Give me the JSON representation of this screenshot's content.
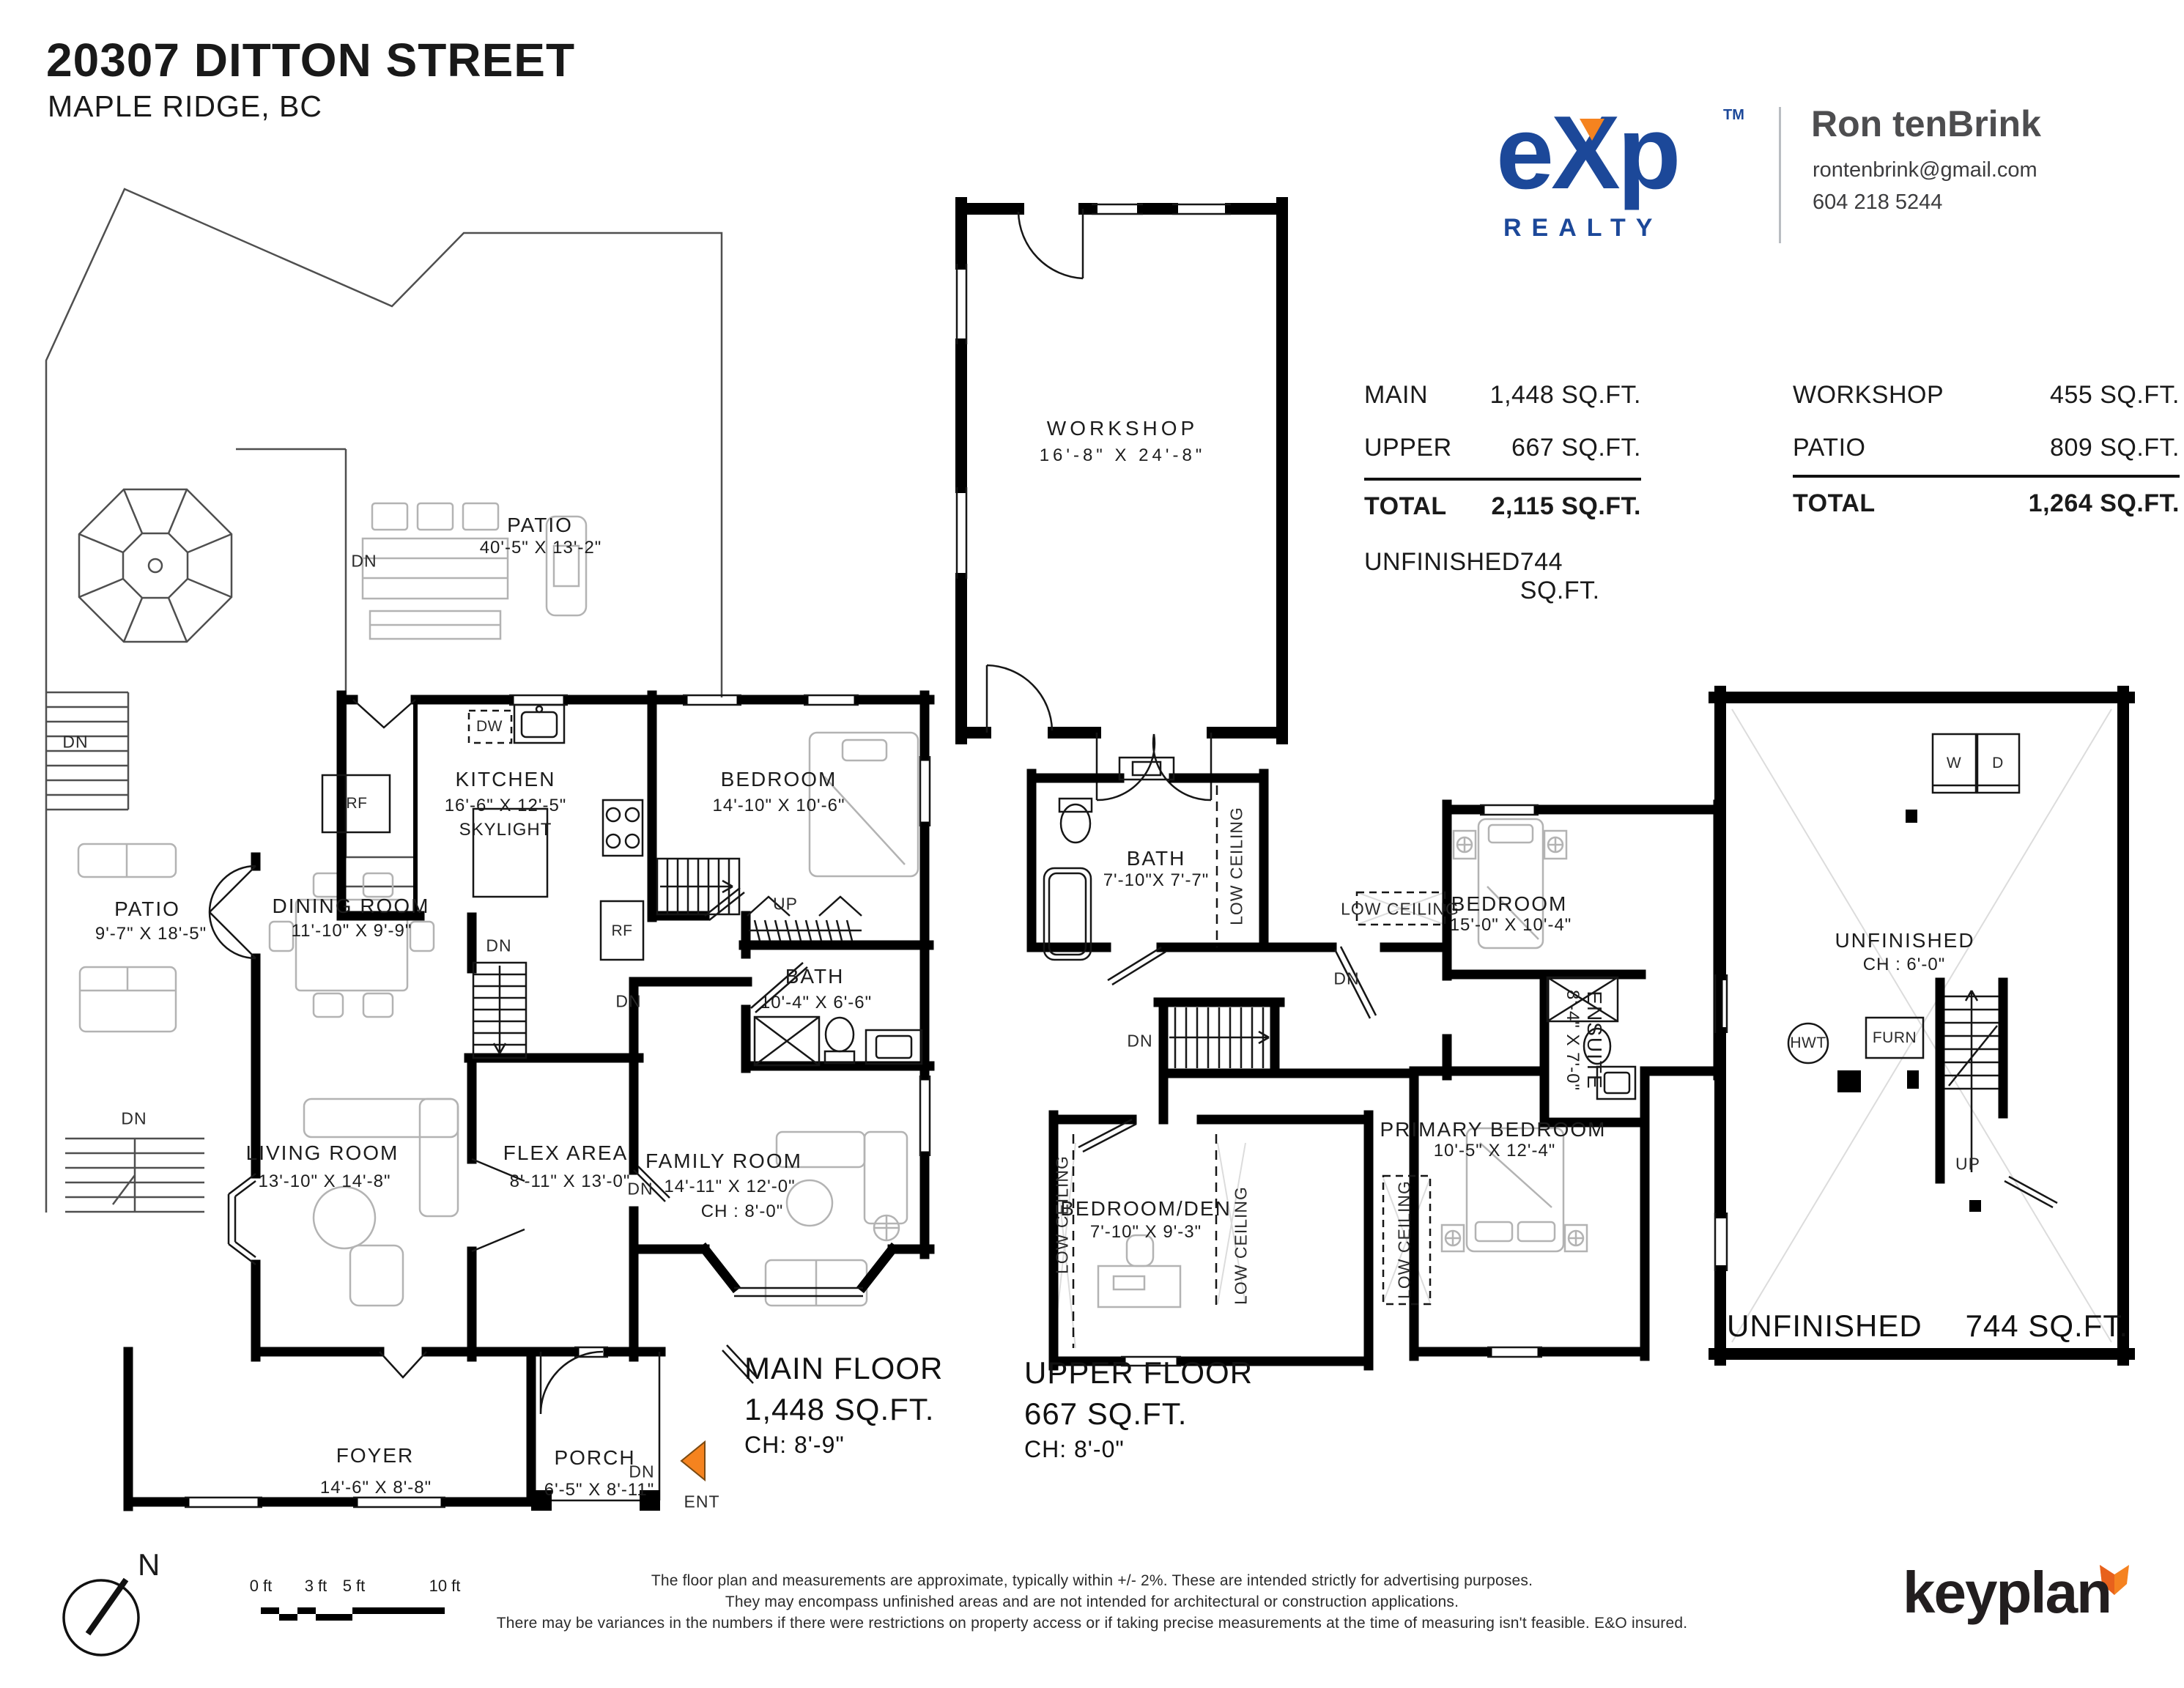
{
  "header": {
    "address": "20307 DITTON STREET",
    "city": "MAPLE RIDGE, BC"
  },
  "brand": {
    "exp": "eXp",
    "tm": "TM",
    "realty": "REALTY",
    "blue": "#1c4899",
    "orange": "#f5831f",
    "agent_name": "Ron tenBrink",
    "agent_email": "rontenbrink@gmail.com",
    "agent_phone": "604 218 5244"
  },
  "area_table": {
    "left": {
      "rows": [
        {
          "label": "MAIN",
          "value": "1,448 SQ.FT."
        },
        {
          "label": "UPPER",
          "value": "667 SQ.FT."
        }
      ],
      "total": {
        "label": "TOTAL",
        "value": "2,115 SQ.FT."
      },
      "unfinished": {
        "label": "UNFINISHED",
        "value": "744 SQ.FT."
      }
    },
    "right": {
      "rows": [
        {
          "label": "WORKSHOP",
          "value": "455 SQ.FT."
        },
        {
          "label": "PATIO",
          "value": "809 SQ.FT."
        }
      ],
      "total": {
        "label": "TOTAL",
        "value": "1,264 SQ.FT."
      }
    }
  },
  "plan_labels": {
    "patio_top": "PATIO",
    "patio_top_dims": "40'-5\" X 13'-2\"",
    "dn_patio_top": "DN",
    "dn_yard_left": "DN",
    "kitchen": "KITCHEN",
    "kitchen_dims": "16'-6\" X 12'-5\"",
    "kitchen_skylight": "SKYLIGHT",
    "dw": "DW",
    "rf_nook": "RF",
    "rf": "RF",
    "bedroom_main": "BEDROOM",
    "bedroom_main_dims": "14'-10\" X 10'-6\"",
    "bath_main": "BATH",
    "bath_main_dims": "10'-4\" X 6'-6\"",
    "dining": "DINING ROOM",
    "dining_dims": "11'-10\" X 9'-9\"",
    "patio_side": "PATIO",
    "patio_side_dims": "9'-7\" X 18'-5\"",
    "dn_basement_stairs": "DN",
    "dn_kitchen_side": "DN",
    "up_main": "UP",
    "living": "LIVING ROOM",
    "living_dims": "13'-10\" X 14'-8\"",
    "flex": "FLEX AREA",
    "flex_dims": "8'-11\" X 13'-0\"",
    "dn_flex": "DN",
    "family": "FAMILY ROOM",
    "family_dims": "14'-11\" X 12'-0\"",
    "family_ch": "CH : 8'-0\"",
    "dn_side_patio": "DN",
    "foyer": "FOYER",
    "foyer_dims": "14'-6\" X 8'-8\"",
    "porch": "PORCH",
    "porch_dims": "6'-5\" X 8'-11\"",
    "dn_porch": "DN",
    "ent": "ENT",
    "workshop": "WORKSHOP",
    "workshop_dims": "16'-8\" X 24'-8\"",
    "bath_upper": "BATH",
    "bath_upper_dims": "7'-10\"X 7'-7\"",
    "low_ceiling_bath": "LOW CEILING",
    "dn_upper_stairs": "DN",
    "dn_upper_door": "DN",
    "low_ceiling_bedroom": "LOW CEILING",
    "bedroom_upper": "BEDROOM",
    "bedroom_upper_dims": "15'-0\" X 10'-4\"",
    "ensuite": "ENSUITE",
    "ensuite_dims": "8'-4\" X 7'-0\"",
    "primary": "PRIMARY BEDROOM",
    "primary_dims": "10'-5\" X 12'-4\"",
    "low_ceiling_primary": "LOW CEILING",
    "bedroom_den": "BEDROOM/DEN",
    "bedroom_den_dims": "7'-10\" X 9'-3\"",
    "low_ceiling_den_left": "LOW CEILING",
    "low_ceiling_den_right": "LOW CEILING",
    "washer": "W",
    "dryer": "D",
    "unfinished": "UNFINISHED",
    "unfinished_ch": "CH : 6'-0\"",
    "hwt": "HWT",
    "furn": "FURN",
    "up_basement": "UP"
  },
  "captions": {
    "main": {
      "l1": "MAIN FLOOR",
      "l2": "1,448 SQ.FT.",
      "l3": "CH: 8'-9\""
    },
    "upper": {
      "l1": "UPPER FLOOR",
      "l2": "667 SQ.FT.",
      "l3": "CH: 8'-0\""
    },
    "basement": {
      "label": "UNFINISHED",
      "value": "744 SQ.FT."
    }
  },
  "footer": {
    "north": "N",
    "scale_labels": [
      "0 ft",
      "3 ft",
      "5 ft",
      "10 ft"
    ],
    "disclaimer": [
      "The floor plan and measurements are approximate, typically within +/- 2%. These are intended strictly for advertising purposes.",
      "They may encompass unfinished areas and are not intended for architectural or construction applications.",
      "There may be variances in the numbers if there were restrictions on property access or if taking precise measurements at the time of measuring isn't feasible. E&O insured."
    ],
    "brand": "keyplan"
  }
}
